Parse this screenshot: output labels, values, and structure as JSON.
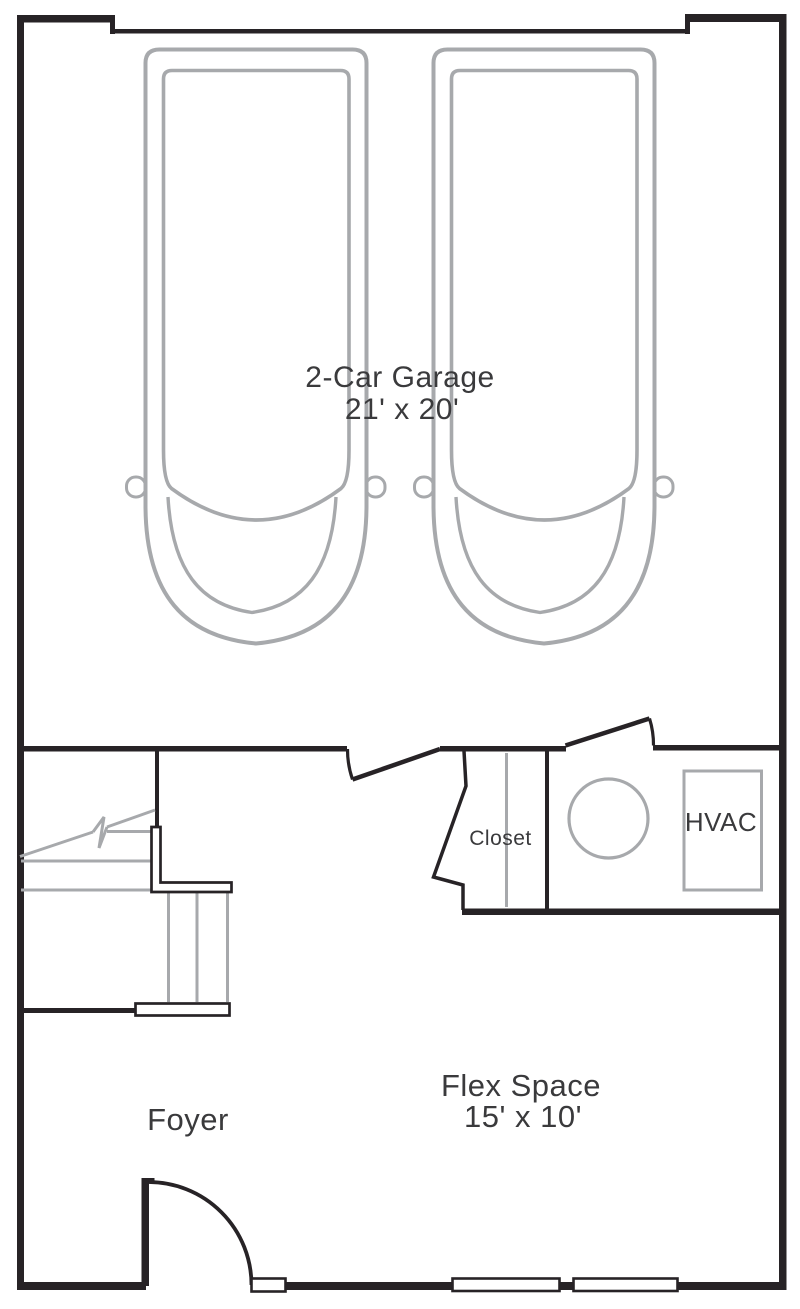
{
  "rooms": {
    "garage": {
      "label": "2-Car Garage",
      "dims": "21' x 20'"
    },
    "closet": {
      "label": "Closet"
    },
    "hvac_closet": {
      "label": "HVAC"
    },
    "foyer": {
      "label": "Foyer"
    },
    "flex": {
      "label": "Flex Space",
      "dims": "15' x 10'"
    }
  },
  "colors": {
    "wall": "#272326",
    "line_gray": "#a7a9ac",
    "text": "#3a3a3c",
    "background": "#ffffff"
  },
  "features": {
    "cars": 2,
    "swing_doors": 3,
    "windows": 3,
    "water_heater_circles": 1,
    "hvac_units": 1,
    "staircases": 1
  }
}
